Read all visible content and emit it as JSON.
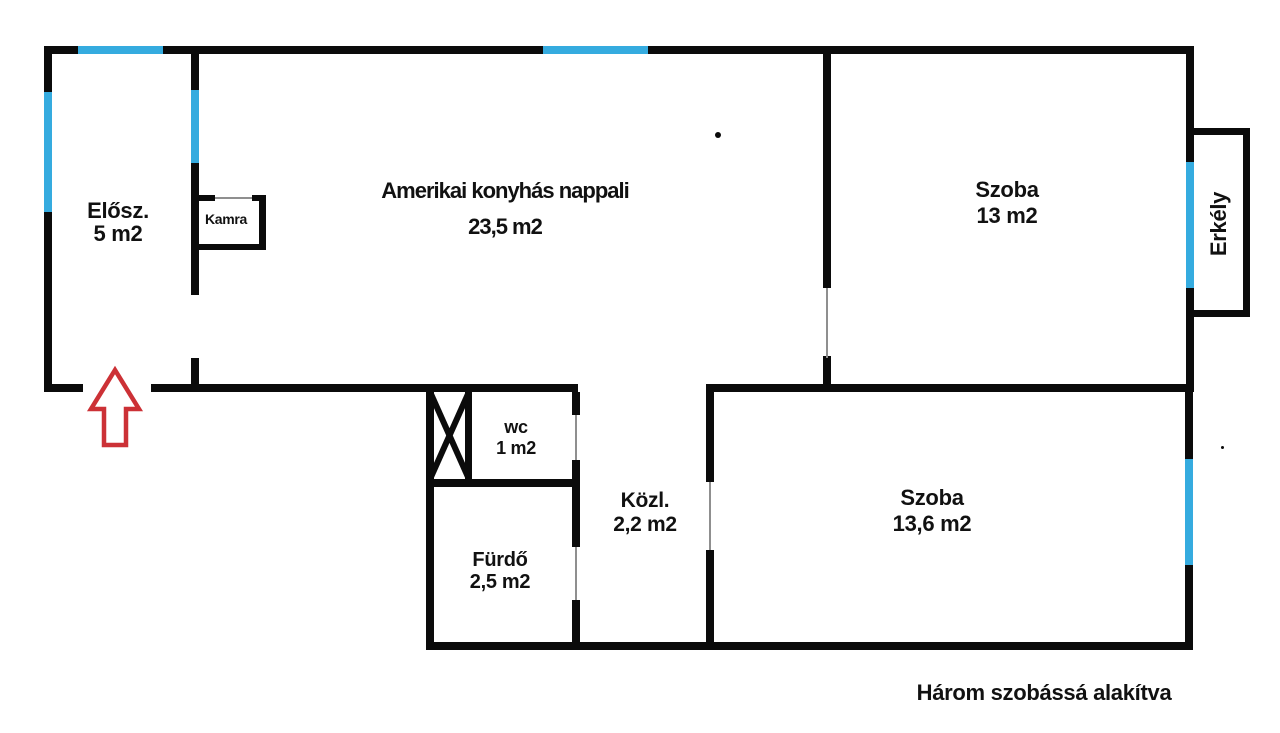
{
  "title": "floor-plan",
  "colors": {
    "wall": "#0b0b0b",
    "window": "#35abdf",
    "door": "#8f8f8f",
    "arrow": "#cc3136",
    "ink": "#111111"
  },
  "rooms": {
    "eloszoba": {
      "name": "Elősz.",
      "area": "5 m2"
    },
    "kamra": {
      "name": "Kamra"
    },
    "nappali": {
      "name": "Amerikai konyhás nappali",
      "area": "23,5 m2"
    },
    "szoba1": {
      "name": "Szoba",
      "area": "13 m2"
    },
    "erkely": {
      "name": "Erkély"
    },
    "wc": {
      "name": "wc",
      "area": "1 m2"
    },
    "kozlekedo": {
      "name": "Közl.",
      "area": "2,2 m2"
    },
    "furdo": {
      "name": "Fürdő",
      "area": "2,5 m2"
    },
    "szoba2": {
      "name": "Szoba",
      "area": "13,6 m2"
    }
  },
  "caption": "Három szobássá alakítva"
}
